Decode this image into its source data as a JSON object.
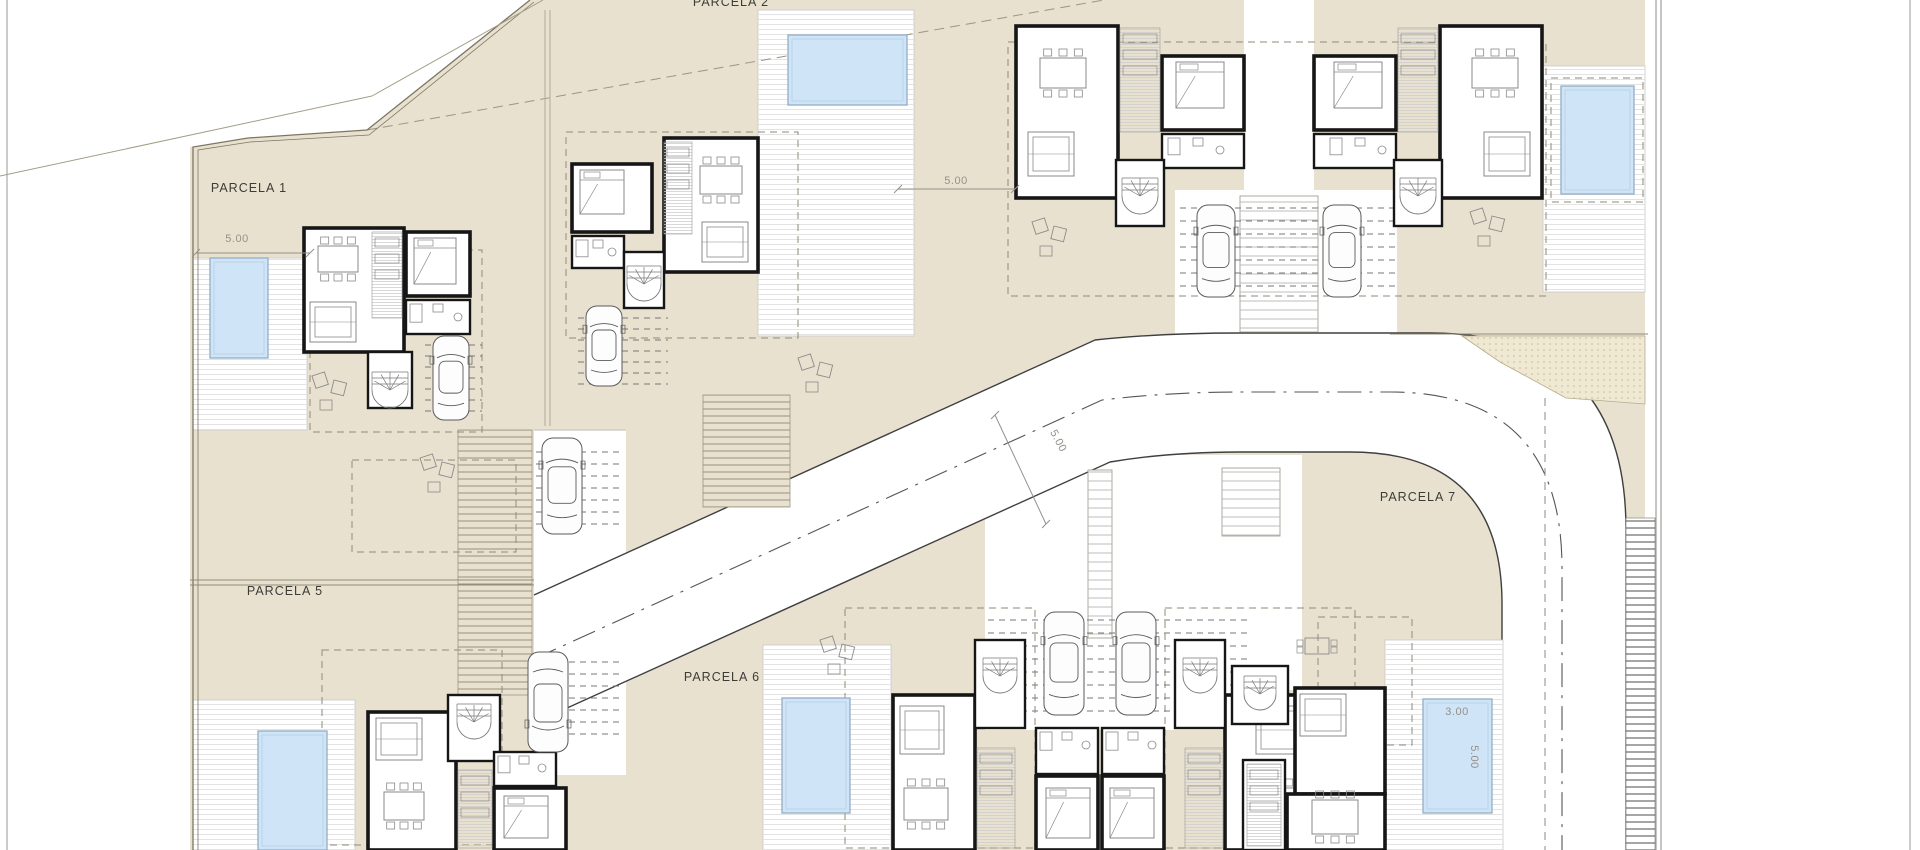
{
  "sheet": {
    "width": 1920,
    "height": 850,
    "type": "residential site plan, ground floor"
  },
  "colors": {
    "paper": "#ffffff",
    "terrain": "#e9e1d0",
    "terrain_line": "#7c7663",
    "deck_line": "#e3e3e3",
    "pool_fill": "#cfe4f6",
    "pool_stroke": "#93aec6",
    "wall": "#161616",
    "furniture": "#8a8a8a",
    "road_edge": "#3f3f3f",
    "centerline": "#555555",
    "dash": "#8f8a78",
    "stipple_bg": "#efe8d3",
    "stipple_dot": "#c6b98e",
    "label": "#3c3c36",
    "dim": "#95908a",
    "frame": "#9a9a9a"
  },
  "labels": [
    {
      "kind": "parcel",
      "text": "PARCELA 1",
      "x": 249,
      "y": 188,
      "rot": 0
    },
    {
      "kind": "parcel",
      "text": "PARCELA 2",
      "x": 731,
      "y": 2,
      "rot": 0
    },
    {
      "kind": "parcel",
      "text": "PARCELA 5",
      "x": 285,
      "y": 591,
      "rot": 0
    },
    {
      "kind": "parcel",
      "text": "PARCELA 6",
      "x": 722,
      "y": 677,
      "rot": 0
    },
    {
      "kind": "parcel",
      "text": "PARCELA 7",
      "x": 1418,
      "y": 497,
      "rot": 0
    },
    {
      "kind": "dim",
      "text": "5.00",
      "x": 237,
      "y": 239,
      "rot": 0
    },
    {
      "kind": "dim",
      "text": "5.00",
      "x": 956,
      "y": 181,
      "rot": 0
    },
    {
      "kind": "dim",
      "text": "5.00",
      "x": 1058,
      "y": 441,
      "rot": 62
    },
    {
      "kind": "dim",
      "text": "3.00",
      "x": 1457,
      "y": 712,
      "rot": 0
    },
    {
      "kind": "dim",
      "text": "5.00",
      "x": 1474,
      "y": 757,
      "rot": 90
    }
  ],
  "terrain_base": {
    "x": 190,
    "y": 0,
    "w": 1455,
    "h": 850
  },
  "white_cutouts": [
    {
      "name": "outside-boundary-top-left",
      "pts": [
        [
          190,
          0
        ],
        [
          530,
          0
        ],
        [
          367,
          130
        ],
        [
          248,
          138
        ],
        [
          190,
          147
        ]
      ]
    }
  ],
  "white_rects": [
    {
      "name": "drive-left",
      "x": 534,
      "y": 430,
      "w": 92,
      "h": 345
    },
    {
      "name": "drive-bottom-middle",
      "x": 985,
      "y": 455,
      "w": 268,
      "h": 275
    },
    {
      "name": "drive-top-right",
      "x": 1175,
      "y": 190,
      "w": 222,
      "h": 145
    },
    {
      "name": "drive-parcela7",
      "x": 1222,
      "y": 455,
      "w": 80,
      "h": 235
    },
    {
      "name": "courtyard-top-right",
      "x": 1244,
      "y": 0,
      "w": 70,
      "h": 196
    }
  ],
  "road": {
    "fill": "M 534,595 L 1095,340 Q 1160,333 1240,333 L 1430,333 Q 1626,333 1626,530 L 1626,850 L 1502,850 L 1502,604 Q 1502,452 1350,452 L 1240,452 Q 1170,452 1110,462 L 534,723 Z",
    "north_edge": "M 534,595 L 1095,340 Q 1160,333 1240,333 L 1430,333 Q 1626,333 1626,530 L 1626,850",
    "south_edge": "M 534,723 L 1110,462 Q 1170,452 1240,452 L 1350,452 Q 1502,452 1502,604 L 1502,850",
    "centerline": "M 534,659 L 1102,400 Q 1170,392 1240,392 L 1390,392 Q 1562,392 1562,568 L 1562,850"
  },
  "stipple": {
    "pts": [
      [
        1462,
        336
      ],
      [
        1645,
        336
      ],
      [
        1645,
        404
      ],
      [
        1566,
        398
      ],
      [
        1500,
        362
      ]
    ]
  },
  "decks": [
    {
      "x": 193,
      "y": 258,
      "w": 114,
      "h": 172
    },
    {
      "x": 758,
      "y": 10,
      "w": 156,
      "h": 326
    },
    {
      "x": 1543,
      "y": 66,
      "w": 102,
      "h": 226
    },
    {
      "x": 193,
      "y": 700,
      "w": 162,
      "h": 150
    },
    {
      "x": 763,
      "y": 645,
      "w": 128,
      "h": 205
    },
    {
      "x": 1385,
      "y": 640,
      "w": 118,
      "h": 210
    }
  ],
  "strips": [
    {
      "x": 458,
      "y": 430,
      "w": 74,
      "h": 265,
      "k": "beige"
    },
    {
      "x": 703,
      "y": 395,
      "w": 87,
      "h": 112,
      "k": "beige"
    },
    {
      "x": 1240,
      "y": 196,
      "w": 78,
      "h": 136,
      "k": "light"
    },
    {
      "x": 1088,
      "y": 470,
      "w": 24,
      "h": 168,
      "k": "light"
    },
    {
      "x": 1222,
      "y": 468,
      "w": 58,
      "h": 68,
      "k": "light"
    },
    {
      "x": 1626,
      "y": 518,
      "w": 29,
      "h": 332,
      "k": "dark"
    }
  ],
  "pools": [
    {
      "name": "pool-parcela-1",
      "x": 210,
      "y": 258,
      "w": 58,
      "h": 100
    },
    {
      "name": "pool-parcela-2",
      "x": 788,
      "y": 35,
      "w": 119,
      "h": 70
    },
    {
      "name": "pool-top-right",
      "x": 1561,
      "y": 86,
      "w": 73,
      "h": 108
    },
    {
      "name": "pool-parcela-5",
      "x": 258,
      "y": 731,
      "w": 69,
      "h": 119
    },
    {
      "name": "pool-parcela-6",
      "x": 782,
      "y": 698,
      "w": 68,
      "h": 115
    },
    {
      "name": "pool-parcela-7",
      "x": 1423,
      "y": 699,
      "w": 69,
      "h": 114
    }
  ],
  "houses": [
    {
      "name": "house-parcela-1",
      "rooms": [
        {
          "x": 304,
          "y": 228,
          "w": 100,
          "h": 124
        },
        {
          "x": 406,
          "y": 232,
          "w": 64,
          "h": 64
        },
        {
          "x": 406,
          "y": 300,
          "w": 64,
          "h": 34,
          "t": "thin"
        },
        {
          "x": 368,
          "y": 352,
          "w": 44,
          "h": 56,
          "t": "thin"
        }
      ],
      "hatch": [
        {
          "x": 372,
          "y": 232,
          "w": 30,
          "h": 86
        }
      ],
      "furn": [
        {
          "t": "table",
          "x": 318,
          "y": 246,
          "w": 40,
          "h": 26
        },
        {
          "t": "sofa",
          "x": 310,
          "y": 302,
          "w": 46,
          "h": 40
        },
        {
          "t": "bed",
          "x": 414,
          "y": 238,
          "w": 42,
          "h": 46
        },
        {
          "t": "bath",
          "x": 410,
          "y": 304,
          "w": 56,
          "h": 26
        },
        {
          "t": "stair",
          "cx": 390,
          "cy": 390,
          "r": 18
        }
      ]
    },
    {
      "name": "house-parcela-2",
      "rooms": [
        {
          "x": 664,
          "y": 138,
          "w": 94,
          "h": 134
        },
        {
          "x": 572,
          "y": 164,
          "w": 80,
          "h": 68
        },
        {
          "x": 572,
          "y": 236,
          "w": 52,
          "h": 32,
          "t": "thin"
        },
        {
          "x": 624,
          "y": 252,
          "w": 40,
          "h": 56,
          "t": "thin"
        }
      ],
      "hatch": [
        {
          "x": 664,
          "y": 142,
          "w": 28,
          "h": 92
        }
      ],
      "furn": [
        {
          "t": "table",
          "x": 700,
          "y": 166,
          "w": 42,
          "h": 28
        },
        {
          "t": "sofa",
          "x": 702,
          "y": 222,
          "w": 46,
          "h": 40
        },
        {
          "t": "bed",
          "x": 580,
          "y": 170,
          "w": 44,
          "h": 44
        },
        {
          "t": "bath",
          "x": 576,
          "y": 240,
          "w": 44,
          "h": 24
        },
        {
          "t": "stair",
          "cx": 644,
          "cy": 284,
          "r": 17
        }
      ]
    },
    {
      "name": "house-top-right-left-unit",
      "rooms": [
        {
          "x": 1016,
          "y": 26,
          "w": 102,
          "h": 172
        },
        {
          "x": 1162,
          "y": 56,
          "w": 82,
          "h": 74
        },
        {
          "x": 1162,
          "y": 134,
          "w": 82,
          "h": 34,
          "t": "thin"
        },
        {
          "x": 1116,
          "y": 160,
          "w": 48,
          "h": 66,
          "t": "thin"
        }
      ],
      "hatch": [
        {
          "x": 1120,
          "y": 28,
          "w": 40,
          "h": 104
        }
      ],
      "furn": [
        {
          "t": "table",
          "x": 1040,
          "y": 58,
          "w": 46,
          "h": 30
        },
        {
          "t": "sofa",
          "x": 1028,
          "y": 132,
          "w": 46,
          "h": 44
        },
        {
          "t": "bed",
          "x": 1176,
          "y": 62,
          "w": 48,
          "h": 46
        },
        {
          "t": "bath",
          "x": 1168,
          "y": 138,
          "w": 60,
          "h": 24
        },
        {
          "t": "stair",
          "cx": 1140,
          "cy": 196,
          "r": 18
        }
      ]
    },
    {
      "name": "house-top-right-right-unit",
      "rooms": [
        {
          "x": 1440,
          "y": 26,
          "w": 102,
          "h": 172
        },
        {
          "x": 1314,
          "y": 56,
          "w": 82,
          "h": 74
        },
        {
          "x": 1314,
          "y": 134,
          "w": 82,
          "h": 34,
          "t": "thin"
        },
        {
          "x": 1394,
          "y": 160,
          "w": 48,
          "h": 66,
          "t": "thin"
        }
      ],
      "hatch": [
        {
          "x": 1398,
          "y": 28,
          "w": 40,
          "h": 104
        }
      ],
      "furn": [
        {
          "t": "table",
          "x": 1472,
          "y": 58,
          "w": 46,
          "h": 30
        },
        {
          "t": "sofa",
          "x": 1484,
          "y": 132,
          "w": 46,
          "h": 44
        },
        {
          "t": "bed",
          "x": 1334,
          "y": 62,
          "w": 48,
          "h": 46
        },
        {
          "t": "bath",
          "x": 1330,
          "y": 138,
          "w": 60,
          "h": 24
        },
        {
          "t": "stair",
          "cx": 1418,
          "cy": 196,
          "r": 18
        }
      ]
    },
    {
      "name": "house-parcela-5",
      "rooms": [
        {
          "x": 368,
          "y": 712,
          "w": 88,
          "h": 138
        },
        {
          "x": 448,
          "y": 695,
          "w": 52,
          "h": 66,
          "t": "thin"
        },
        {
          "x": 494,
          "y": 752,
          "w": 62,
          "h": 34,
          "t": "thin"
        },
        {
          "x": 494,
          "y": 788,
          "w": 72,
          "h": 62
        }
      ],
      "hatch": [
        {
          "x": 458,
          "y": 770,
          "w": 34,
          "h": 78
        }
      ],
      "furn": [
        {
          "t": "sofa",
          "x": 376,
          "y": 718,
          "w": 46,
          "h": 42
        },
        {
          "t": "table",
          "x": 384,
          "y": 792,
          "w": 40,
          "h": 28
        },
        {
          "t": "bed",
          "x": 504,
          "y": 796,
          "w": 44,
          "h": 42
        },
        {
          "t": "bath",
          "x": 498,
          "y": 756,
          "w": 52,
          "h": 24
        },
        {
          "t": "stair",
          "cx": 474,
          "cy": 722,
          "r": 17
        }
      ]
    },
    {
      "name": "house-parcela-6-left",
      "rooms": [
        {
          "x": 893,
          "y": 695,
          "w": 82,
          "h": 155
        },
        {
          "x": 975,
          "y": 640,
          "w": 50,
          "h": 88,
          "t": "thin"
        },
        {
          "x": 1036,
          "y": 728,
          "w": 62,
          "h": 46,
          "t": "thin"
        },
        {
          "x": 1036,
          "y": 776,
          "w": 62,
          "h": 74
        }
      ],
      "hatch": [
        {
          "x": 977,
          "y": 748,
          "w": 38,
          "h": 100
        }
      ],
      "furn": [
        {
          "t": "sofa",
          "x": 900,
          "y": 706,
          "w": 44,
          "h": 48
        },
        {
          "t": "table",
          "x": 904,
          "y": 788,
          "w": 44,
          "h": 32
        },
        {
          "t": "bed",
          "x": 1046,
          "y": 788,
          "w": 44,
          "h": 50
        },
        {
          "t": "bath",
          "x": 1040,
          "y": 732,
          "w": 54,
          "h": 26
        },
        {
          "t": "stair",
          "cx": 1000,
          "cy": 676,
          "r": 17
        }
      ]
    },
    {
      "name": "house-parcela-6-right",
      "rooms": [
        {
          "x": 1225,
          "y": 695,
          "w": 82,
          "h": 155
        },
        {
          "x": 1175,
          "y": 640,
          "w": 50,
          "h": 88,
          "t": "thin"
        },
        {
          "x": 1102,
          "y": 728,
          "w": 62,
          "h": 46,
          "t": "thin"
        },
        {
          "x": 1102,
          "y": 776,
          "w": 62,
          "h": 74
        }
      ],
      "hatch": [
        {
          "x": 1185,
          "y": 748,
          "w": 38,
          "h": 100
        }
      ],
      "furn": [
        {
          "t": "sofa",
          "x": 1256,
          "y": 706,
          "w": 44,
          "h": 48
        },
        {
          "t": "table",
          "x": 1252,
          "y": 788,
          "w": 44,
          "h": 32
        },
        {
          "t": "bed",
          "x": 1110,
          "y": 788,
          "w": 44,
          "h": 50
        },
        {
          "t": "bath",
          "x": 1106,
          "y": 732,
          "w": 54,
          "h": 26
        },
        {
          "t": "stair",
          "cx": 1200,
          "cy": 676,
          "r": 17
        }
      ]
    },
    {
      "name": "house-parcela-7",
      "rooms": [
        {
          "x": 1295,
          "y": 688,
          "w": 90,
          "h": 106
        },
        {
          "x": 1232,
          "y": 666,
          "w": 56,
          "h": 58,
          "t": "thin"
        },
        {
          "x": 1243,
          "y": 760,
          "w": 42,
          "h": 90,
          "t": "thin"
        },
        {
          "x": 1287,
          "y": 794,
          "w": 98,
          "h": 56
        }
      ],
      "hatch": [
        {
          "x": 1247,
          "y": 764,
          "w": 34,
          "h": 82
        }
      ],
      "furn": [
        {
          "t": "sofa",
          "x": 1300,
          "y": 694,
          "w": 46,
          "h": 42
        },
        {
          "t": "table",
          "x": 1312,
          "y": 800,
          "w": 46,
          "h": 34
        },
        {
          "t": "stair",
          "cx": 1260,
          "cy": 694,
          "r": 16
        }
      ]
    }
  ],
  "cars": [
    {
      "x": 433,
      "y": 336,
      "w": 36,
      "h": 84
    },
    {
      "x": 586,
      "y": 306,
      "w": 36,
      "h": 80
    },
    {
      "x": 1197,
      "y": 205,
      "w": 38,
      "h": 92
    },
    {
      "x": 1323,
      "y": 205,
      "w": 38,
      "h": 92
    },
    {
      "x": 542,
      "y": 438,
      "w": 40,
      "h": 96
    },
    {
      "x": 528,
      "y": 652,
      "w": 40,
      "h": 100,
      "flip": true
    },
    {
      "x": 1044,
      "y": 612,
      "w": 40,
      "h": 103
    },
    {
      "x": 1116,
      "y": 612,
      "w": 40,
      "h": 103
    }
  ],
  "loungers": [
    {
      "x": 312,
      "y": 376
    },
    {
      "x": 420,
      "y": 458
    },
    {
      "x": 798,
      "y": 358
    },
    {
      "x": 1032,
      "y": 222
    },
    {
      "x": 1470,
      "y": 212
    },
    {
      "x": 820,
      "y": 640
    }
  ],
  "garden_sets": [
    {
      "x": 1305,
      "y": 638
    }
  ],
  "dash_rects": [
    {
      "x": 310,
      "y": 250,
      "w": 172,
      "h": 182
    },
    {
      "x": 566,
      "y": 132,
      "w": 232,
      "h": 206
    },
    {
      "x": 1008,
      "y": 42,
      "w": 538,
      "h": 254
    },
    {
      "x": 352,
      "y": 460,
      "w": 164,
      "h": 92
    },
    {
      "x": 845,
      "y": 608,
      "w": 190,
      "h": 240
    },
    {
      "x": 1165,
      "y": 608,
      "w": 190,
      "h": 240
    },
    {
      "x": 1318,
      "y": 617,
      "w": 94,
      "h": 128
    },
    {
      "x": 322,
      "y": 650,
      "w": 180,
      "h": 195
    },
    {
      "x": 1551,
      "y": 78,
      "w": 92,
      "h": 124
    }
  ],
  "dash_groups": [
    {
      "x1": 425,
      "x2": 482,
      "y": 345,
      "n": 7,
      "s": 11
    },
    {
      "x1": 578,
      "x2": 668,
      "y": 318,
      "n": 7,
      "s": 11
    },
    {
      "x1": 1180,
      "x2": 1396,
      "y": 208,
      "n": 7,
      "s": 13
    },
    {
      "x1": 988,
      "x2": 1252,
      "y": 620,
      "n": 8,
      "s": 13
    },
    {
      "x1": 536,
      "x2": 624,
      "y": 452,
      "n": 7,
      "s": 12
    },
    {
      "x1": 536,
      "x2": 624,
      "y": 662,
      "n": 7,
      "s": 12
    }
  ],
  "boundary": {
    "main": [
      [
        193,
        850
      ],
      [
        193,
        147
      ],
      [
        248,
        138
      ],
      [
        367,
        130
      ],
      [
        530,
        0
      ]
    ],
    "second": [
      [
        198,
        850
      ],
      [
        198,
        150
      ],
      [
        250,
        142
      ],
      [
        369,
        135
      ],
      [
        534,
        2
      ]
    ],
    "thin1": [
      [
        0,
        176
      ],
      [
        372,
        96
      ]
    ],
    "thin2": [
      [
        372,
        96
      ],
      [
        543,
        0
      ]
    ],
    "shallow_dashed": [
      [
        367,
        130
      ],
      [
        1104,
        0
      ]
    ]
  },
  "misc_lines": [
    {
      "x1": 7,
      "y1": 0,
      "x2": 7,
      "y2": 850,
      "c": "#9a9a9a",
      "w": 1
    },
    {
      "x1": 1910,
      "y1": 0,
      "x2": 1910,
      "y2": 850,
      "c": "#9a9a9a",
      "w": 1
    },
    {
      "x1": 1656,
      "y1": 0,
      "x2": 1656,
      "y2": 850,
      "c": "#8b8b8b",
      "w": 1
    },
    {
      "x1": 1661,
      "y1": 0,
      "x2": 1661,
      "y2": 850,
      "c": "#8b8b8b",
      "w": 1
    },
    {
      "x1": 1390,
      "y1": 334,
      "x2": 1648,
      "y2": 334,
      "c": "#8f8a74",
      "w": 1
    },
    {
      "x1": 545,
      "y1": 10,
      "x2": 545,
      "y2": 426,
      "c": "#b0aa96",
      "w": 1
    },
    {
      "x1": 550,
      "y1": 10,
      "x2": 550,
      "y2": 426,
      "c": "#b0aa96",
      "w": 1
    },
    {
      "x1": 190,
      "y1": 580,
      "x2": 534,
      "y2": 580,
      "c": "#8f8a74",
      "w": 1
    },
    {
      "x1": 190,
      "y1": 585,
      "x2": 534,
      "y2": 585,
      "c": "#8f8a74",
      "w": 1
    },
    {
      "x1": 534,
      "y1": 430,
      "x2": 626,
      "y2": 430,
      "c": "#bdbdbd",
      "w": 1
    }
  ],
  "dashed_lines": [
    {
      "x1": 1545,
      "y1": 398,
      "x2": 1545,
      "y2": 850
    }
  ],
  "dim_lines": [
    {
      "x1": 196,
      "y1": 253,
      "x2": 310,
      "y2": 253
    },
    {
      "x1": 898,
      "y1": 189,
      "x2": 1015,
      "y2": 189
    },
    {
      "x1": 995,
      "y1": 415,
      "x2": 1046,
      "y2": 524
    }
  ]
}
